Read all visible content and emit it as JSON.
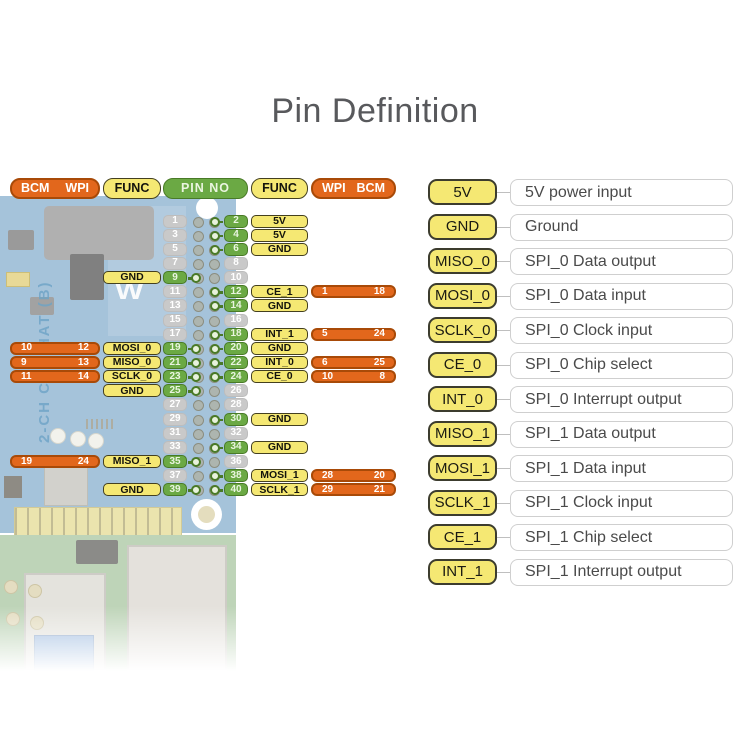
{
  "title": "Pin Definition",
  "board": {
    "label": "2-CH CAN HAT (B)",
    "logo": "W"
  },
  "colors": {
    "orange": "#E2671C",
    "orange_border": "#A84A08",
    "yellow": "#F5E873",
    "yellow_border": "#44401F",
    "green": "#6BA944",
    "green_border": "#497A27",
    "gray_pin": "#C9C9C9",
    "pcb_blue": "#7FA9CB",
    "pi_green": "#A3C29A",
    "title_text": "#58595C",
    "legend_text": "#4A4A4A"
  },
  "pin_table": {
    "headers": {
      "bcm_left": "BCM",
      "wpi_left": "WPI",
      "func_left": "FUNC",
      "pin_no": "PIN NO",
      "func_right": "FUNC",
      "wpi_right": "WPI",
      "bcm_right": "BCM"
    },
    "rows": [
      {
        "odd": {
          "pin": "1",
          "hl": false
        },
        "even": {
          "pin": "2",
          "hl": true,
          "func": "5V"
        }
      },
      {
        "odd": {
          "pin": "3",
          "hl": false
        },
        "even": {
          "pin": "4",
          "hl": true,
          "func": "5V"
        }
      },
      {
        "odd": {
          "pin": "5",
          "hl": false
        },
        "even": {
          "pin": "6",
          "hl": true,
          "func": "GND"
        }
      },
      {
        "odd": {
          "pin": "7",
          "hl": false
        },
        "even": {
          "pin": "8",
          "hl": false
        }
      },
      {
        "odd": {
          "pin": "9",
          "hl": true,
          "func": "GND"
        },
        "even": {
          "pin": "10",
          "hl": false
        }
      },
      {
        "odd": {
          "pin": "11",
          "hl": false
        },
        "even": {
          "pin": "12",
          "hl": true,
          "func": "CE_1",
          "wpi": "1",
          "bcm": "18"
        }
      },
      {
        "odd": {
          "pin": "13",
          "hl": false
        },
        "even": {
          "pin": "14",
          "hl": true,
          "func": "GND"
        }
      },
      {
        "odd": {
          "pin": "15",
          "hl": false
        },
        "even": {
          "pin": "16",
          "hl": false
        }
      },
      {
        "odd": {
          "pin": "17",
          "hl": false
        },
        "even": {
          "pin": "18",
          "hl": true,
          "func": "INT_1",
          "wpi": "5",
          "bcm": "24"
        }
      },
      {
        "odd": {
          "pin": "19",
          "hl": true,
          "func": "MOSI_0",
          "bcm": "10",
          "wpi": "12"
        },
        "even": {
          "pin": "20",
          "hl": true,
          "func": "GND"
        }
      },
      {
        "odd": {
          "pin": "21",
          "hl": true,
          "func": "MISO_0",
          "bcm": "9",
          "wpi": "13"
        },
        "even": {
          "pin": "22",
          "hl": true,
          "func": "INT_0",
          "wpi": "6",
          "bcm": "25"
        }
      },
      {
        "odd": {
          "pin": "23",
          "hl": true,
          "func": "SCLK_0",
          "bcm": "11",
          "wpi": "14"
        },
        "even": {
          "pin": "24",
          "hl": true,
          "func": "CE_0",
          "wpi": "10",
          "bcm": "8"
        }
      },
      {
        "odd": {
          "pin": "25",
          "hl": true,
          "func": "GND"
        },
        "even": {
          "pin": "26",
          "hl": false
        }
      },
      {
        "odd": {
          "pin": "27",
          "hl": false
        },
        "even": {
          "pin": "28",
          "hl": false
        }
      },
      {
        "odd": {
          "pin": "29",
          "hl": false
        },
        "even": {
          "pin": "30",
          "hl": true,
          "func": "GND"
        }
      },
      {
        "odd": {
          "pin": "31",
          "hl": false
        },
        "even": {
          "pin": "32",
          "hl": false
        }
      },
      {
        "odd": {
          "pin": "33",
          "hl": false
        },
        "even": {
          "pin": "34",
          "hl": true,
          "func": "GND"
        }
      },
      {
        "odd": {
          "pin": "35",
          "hl": true,
          "func": "MISO_1",
          "bcm": "19",
          "wpi": "24"
        },
        "even": {
          "pin": "36",
          "hl": false
        }
      },
      {
        "odd": {
          "pin": "37",
          "hl": false
        },
        "even": {
          "pin": "38",
          "hl": true,
          "func": "MOSI_1",
          "wpi": "28",
          "bcm": "20"
        }
      },
      {
        "odd": {
          "pin": "39",
          "hl": true,
          "func": "GND"
        },
        "even": {
          "pin": "40",
          "hl": true,
          "func": "SCLK_1",
          "wpi": "29",
          "bcm": "21"
        }
      }
    ]
  },
  "legend": [
    {
      "name": "5V",
      "desc": "5V power input"
    },
    {
      "name": "GND",
      "desc": "Ground"
    },
    {
      "name": "MISO_0",
      "desc": "SPI_0 Data output"
    },
    {
      "name": "MOSI_0",
      "desc": "SPI_0 Data input"
    },
    {
      "name": "SCLK_0",
      "desc": "SPI_0 Clock input"
    },
    {
      "name": "CE_0",
      "desc": "SPI_0 Chip select"
    },
    {
      "name": "INT_0",
      "desc": "SPI_0 Interrupt output"
    },
    {
      "name": "MISO_1",
      "desc": "SPI_1 Data output"
    },
    {
      "name": "MOSI_1",
      "desc": "SPI_1 Data input"
    },
    {
      "name": "SCLK_1",
      "desc": "SPI_1 Clock input"
    },
    {
      "name": "CE_1",
      "desc": "SPI_1 Chip select"
    },
    {
      "name": "INT_1",
      "desc": "SPI_1 Interrupt output"
    }
  ]
}
